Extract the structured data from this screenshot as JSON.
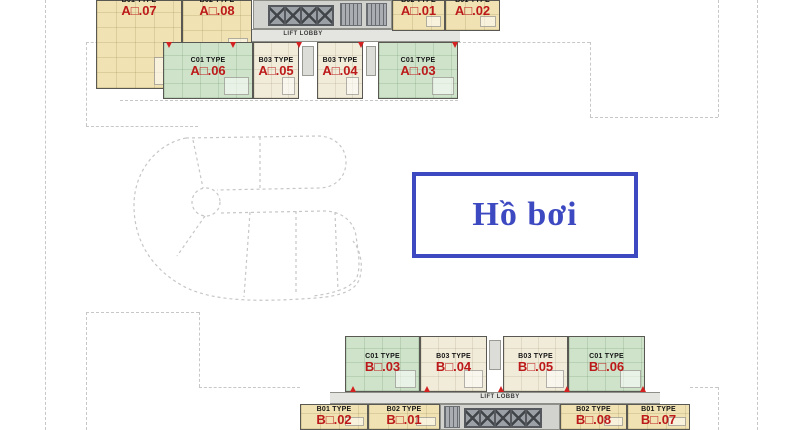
{
  "pool_sign": {
    "label": "Hồ bơi"
  },
  "tower_a": {
    "lift_lobby": "LIFT LOBBY",
    "yellow_row": [
      {
        "type": "B01 TYPE",
        "code": "A□.07"
      },
      {
        "type": "B02 TYPE",
        "code": "A□.08"
      },
      {
        "type": "B02 TYPE",
        "code": "A□.01"
      },
      {
        "type": "B01 TYPE",
        "code": "A□.02"
      }
    ],
    "green_row": [
      {
        "type": "C01 TYPE",
        "code": "A□.06"
      },
      {
        "type": "B03 TYPE",
        "code": "A□.05"
      },
      {
        "type": "B03 TYPE",
        "code": "A□.04"
      },
      {
        "type": "C01 TYPE",
        "code": "A□.03"
      }
    ]
  },
  "tower_b": {
    "lift_lobby": "LIFT LOBBY",
    "green_row": [
      {
        "type": "C01 TYPE",
        "code": "B□.03"
      },
      {
        "type": "B03 TYPE",
        "code": "B□.04"
      },
      {
        "type": "B03 TYPE",
        "code": "B□.05"
      },
      {
        "type": "C01 TYPE",
        "code": "B□.06"
      }
    ],
    "yellow_row": [
      {
        "type": "B01 TYPE",
        "code": "B□.02"
      },
      {
        "type": "B02 TYPE",
        "code": "B□.01"
      },
      {
        "type": "B02 TYPE",
        "code": "B□.08"
      },
      {
        "type": "B01 TYPE",
        "code": "B□.07"
      }
    ]
  },
  "colors": {
    "pool_blue": "#3d49c0",
    "unit_yellow": "#f0e2b2",
    "unit_green": "#cfe3ca",
    "unit_cream": "#f1ebd9",
    "code_red": "#bc1a1a",
    "boundary_gray": "#c7c7c7"
  }
}
